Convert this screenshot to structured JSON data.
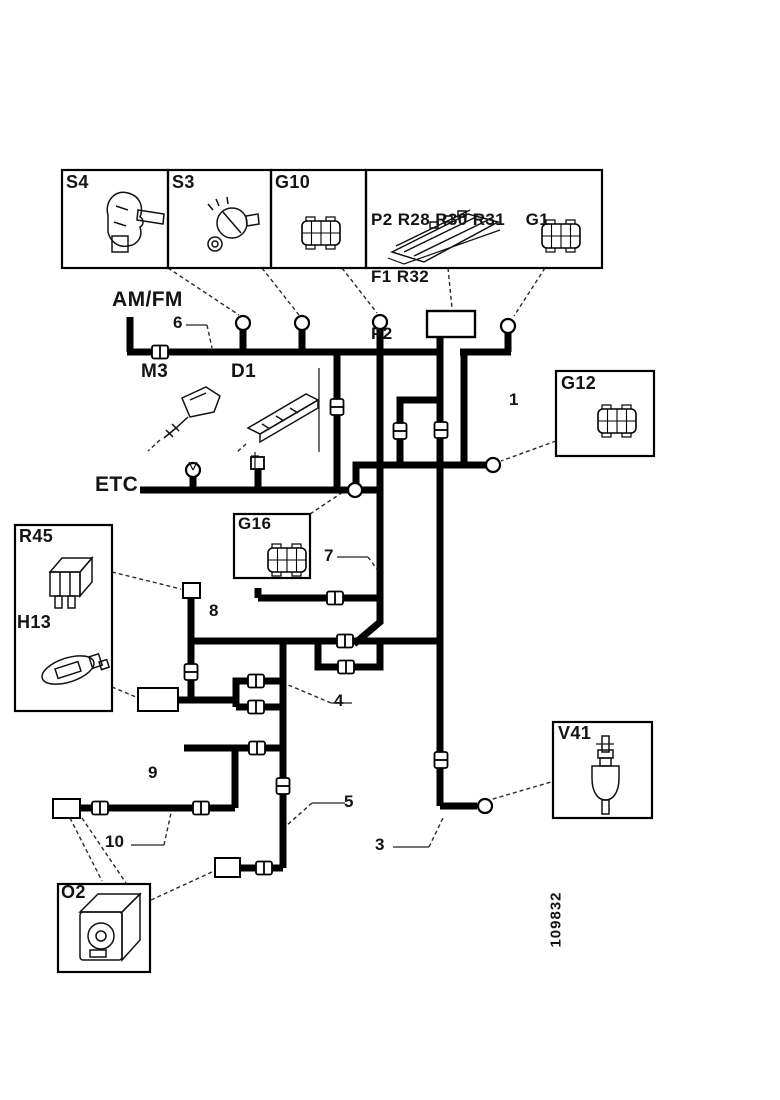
{
  "page": {
    "background": "#ffffff",
    "ink": "#141414",
    "type": "wiring-harness-diagram"
  },
  "part_number": "109832",
  "component_boxes": {
    "s4": {
      "label": "S4"
    },
    "s3": {
      "label": "S3"
    },
    "g10": {
      "label": "G10"
    },
    "fuse_panel": {
      "line1": "P2 R28 R30 R31    G1",
      "line2": "F1 R32",
      "line3": "P2"
    },
    "g12": {
      "label": "G12"
    },
    "g16": {
      "label": "G16"
    },
    "r45": {
      "label": "R45"
    },
    "h13": {
      "label": "H13"
    },
    "v41": {
      "label": "V41"
    },
    "o2": {
      "label": "O2"
    }
  },
  "inline_labels": {
    "amfm": "AM/FM",
    "etc": "ETC",
    "m3": "M3",
    "d1": "D1"
  },
  "wire_numbers": {
    "w1": "1",
    "w3": "3",
    "w4": "4",
    "w5": "5",
    "w6": "6",
    "w7": "7",
    "w8": "8",
    "w9": "9",
    "w10": "10"
  },
  "colors": {
    "wire": "#000000",
    "leader": "#2a2a2a",
    "connector_fill": "#ffffff"
  }
}
